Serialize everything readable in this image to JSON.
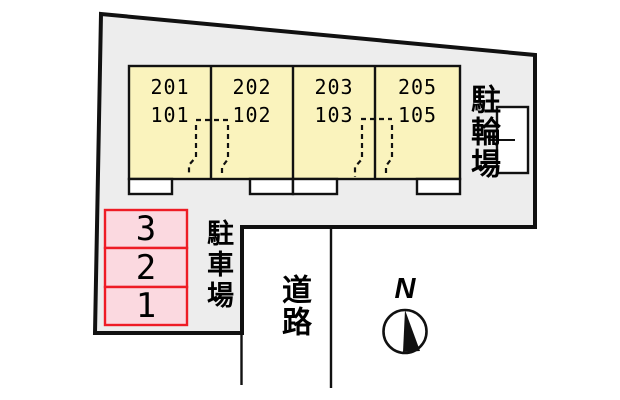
{
  "site": {
    "fill": "#ededed",
    "outline_color": "#111111"
  },
  "building": {
    "fill": "#faf3bd",
    "units": [
      {
        "upper": "201",
        "lower": "101"
      },
      {
        "upper": "202",
        "lower": "102"
      },
      {
        "upper": "203",
        "lower": "103"
      },
      {
        "upper": "205",
        "lower": "105"
      }
    ]
  },
  "bicycle_parking": {
    "label": "駐輪場"
  },
  "car_parking": {
    "label": "駐車場",
    "space_fill": "#fbd9e0",
    "space_border": "#ee1c25",
    "spaces": [
      "3",
      "2",
      "1"
    ]
  },
  "road": {
    "label": "道路"
  },
  "compass": {
    "label": "N"
  }
}
